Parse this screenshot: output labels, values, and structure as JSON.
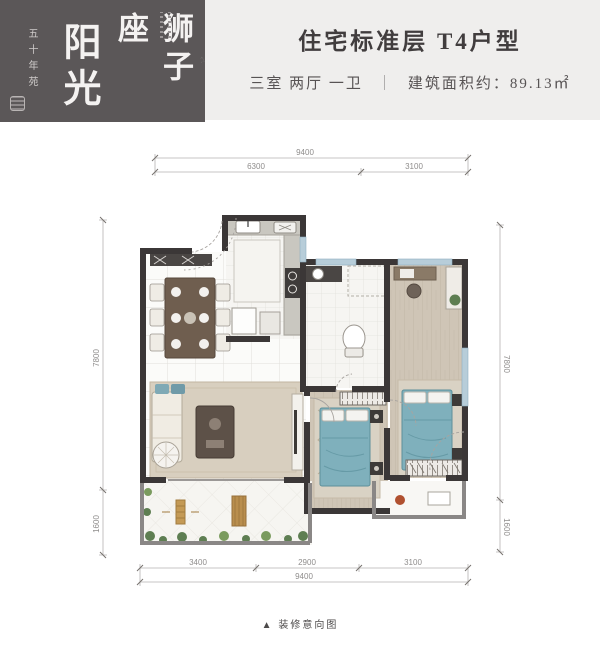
{
  "header": {
    "brand_main": "阳光",
    "brand_sub": "狮子座",
    "side_note": "五十年苑"
  },
  "title_block": {
    "title": "住宅标准层 T4户型",
    "layout": "三室 两厅 一卫",
    "divider": "｜",
    "area": "建筑面积约：89.13㎡"
  },
  "plan": {
    "dims": {
      "top_total": "9400",
      "top_segments": [
        "6300",
        "3100"
      ],
      "bottom_segments": [
        "3400",
        "2900",
        "3100"
      ],
      "bottom_total": "9400",
      "left_segments": [
        "7800",
        "1600"
      ],
      "right_segments": [
        "7800",
        "1600"
      ]
    },
    "caption": "▲ 装修意向图"
  },
  "colors": {
    "header_dark": "#5B5758",
    "band_gray": "#EFEEED",
    "wall_dark": "#3B3737",
    "wall_gray": "#8A8786",
    "window_blue": "#B7CDD9",
    "bed_blue": "#7FB0BC",
    "wood_floor": "#CFC5B6",
    "rug": "#D8CFBF",
    "plant_green": "#5E7E52",
    "dim_text": "#8F8D8C"
  }
}
